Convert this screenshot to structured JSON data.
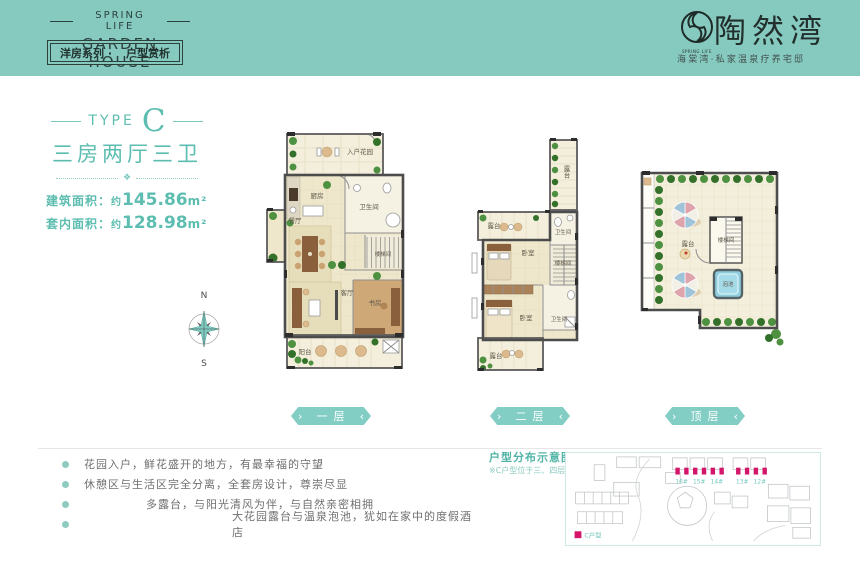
{
  "header": {
    "brand_top": "SPRING LIFE",
    "brand_main": "GARDEN HOUSE",
    "tab": {
      "left": "洋房系列 ·",
      "right": "户型赏析"
    },
    "logo": {
      "name": "陶然湾",
      "icon_sub": "SPRING LIFE",
      "tagline": "海棠湾·私家温泉疗养宅邸"
    }
  },
  "unit": {
    "type_prefix": "TYPE",
    "type_letter": "C",
    "rooms_summary": "三房两厅三卫",
    "areas": [
      {
        "label": "建筑面积：",
        "approx": "约",
        "value": "145.86",
        "unit": "m²"
      },
      {
        "label": "套内面积：",
        "approx": "约",
        "value": "128.98",
        "unit": "m²"
      }
    ]
  },
  "compass": {
    "n": "N",
    "s": "S"
  },
  "floors": {
    "f1": {
      "ribbon": "一层",
      "rooms": {
        "entry_garden": "入户花园",
        "kitchen": "厨房",
        "bath": "卫生间",
        "dining": "餐厅",
        "stairs": "楼梯间",
        "living": "客厅",
        "study": "书房",
        "balcony": "阳台"
      }
    },
    "f2": {
      "ribbon": "二层",
      "rooms": {
        "terrace_top": "露台",
        "terrace_left": "露台",
        "bath_up": "卫生间",
        "bedroom_up": "卧室",
        "stairs": "楼梯间",
        "bedroom_low": "卧室",
        "bath_low": "卫生间",
        "terrace_bottom": "露台"
      }
    },
    "roof": {
      "ribbon": "顶层",
      "rooms": {
        "terrace": "露台",
        "stairs": "楼梯间",
        "pool": "泡池"
      }
    }
  },
  "features": [
    "花园入户，鲜花盛开的地方，有最幸福的守望",
    "休憩区与生活区完全分离，全套房设计，尊崇尽显",
    "多露台，与阳光清风为伴，与自然亲密相拥",
    "大花园露台与温泉泡池，犹如在家中的度假酒店"
  ],
  "site_map": {
    "title": "户型分布示意图",
    "note": "※C户型位于三、四层",
    "buildings": [
      "16#",
      "15#",
      "14#",
      "13#",
      "12#"
    ],
    "legend": "C户型"
  },
  "colors": {
    "accent": "#5cbdb0",
    "header_bg": "#85c9bf",
    "marker": "#d4156a",
    "ribbon": "#82cdc4"
  }
}
